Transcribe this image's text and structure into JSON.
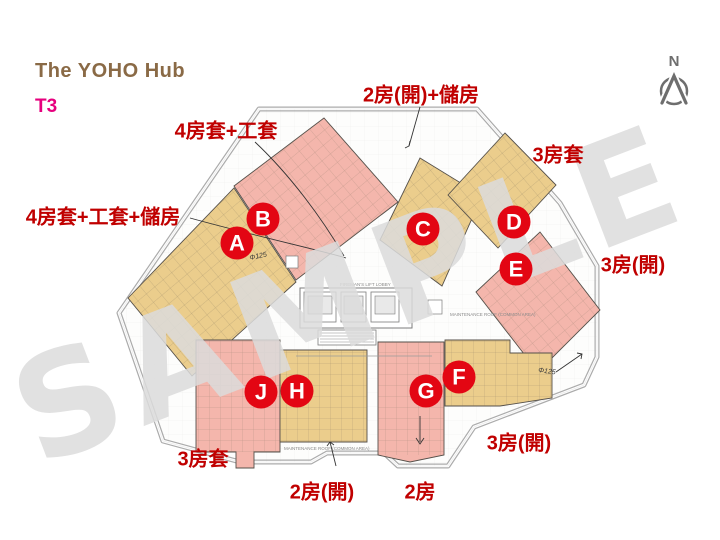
{
  "header": {
    "title": "The YOHO Hub",
    "tower": "T3"
  },
  "compass": {
    "label": "N"
  },
  "watermark": "SAMPLE",
  "unit_type_labels": [
    {
      "id": "top-center",
      "text": "2房(開)+儲房"
    },
    {
      "id": "upper-left",
      "text": "4房套+工套"
    },
    {
      "id": "top-right",
      "text": "3房套"
    },
    {
      "id": "left",
      "text": "4房套+工套+儲房"
    },
    {
      "id": "right",
      "text": "3房(開)"
    },
    {
      "id": "bottom-left",
      "text": "3房套"
    },
    {
      "id": "bottom-center",
      "text": "2房(開)"
    },
    {
      "id": "bottom-mid",
      "text": "2房"
    },
    {
      "id": "bottom-right",
      "text": "3房(開)"
    }
  ],
  "units": [
    {
      "letter": "A",
      "fill": "yellow"
    },
    {
      "letter": "B",
      "fill": "pink"
    },
    {
      "letter": "C",
      "fill": "yellow"
    },
    {
      "letter": "D",
      "fill": "yellow"
    },
    {
      "letter": "E",
      "fill": "pink"
    },
    {
      "letter": "F",
      "fill": "yellow"
    },
    {
      "letter": "G",
      "fill": "pink"
    },
    {
      "letter": "H",
      "fill": "yellow"
    },
    {
      "letter": "J",
      "fill": "pink"
    }
  ],
  "plan_annotations": {
    "maintenance_1": "MAINTENANCE ROOF (COMMON AREA)",
    "maintenance_2": "MAINTENANCE ROOF (COMMON AREA)",
    "lift_lobby": "FIREMAN'S LIFT LOBBY",
    "scribble_1": "Φ125",
    "scribble_2": "Φ125"
  },
  "colors": {
    "unit_yellow": "#ebcd8c",
    "unit_pink": "#f4b6ac",
    "marker_red": "#e30613",
    "label_red": "#c00000",
    "title_brown": "#8a6a46",
    "tower_magenta": "#e6007e",
    "watermark_gray": "#dcdcdc",
    "plan_line_gray": "#ababab"
  }
}
